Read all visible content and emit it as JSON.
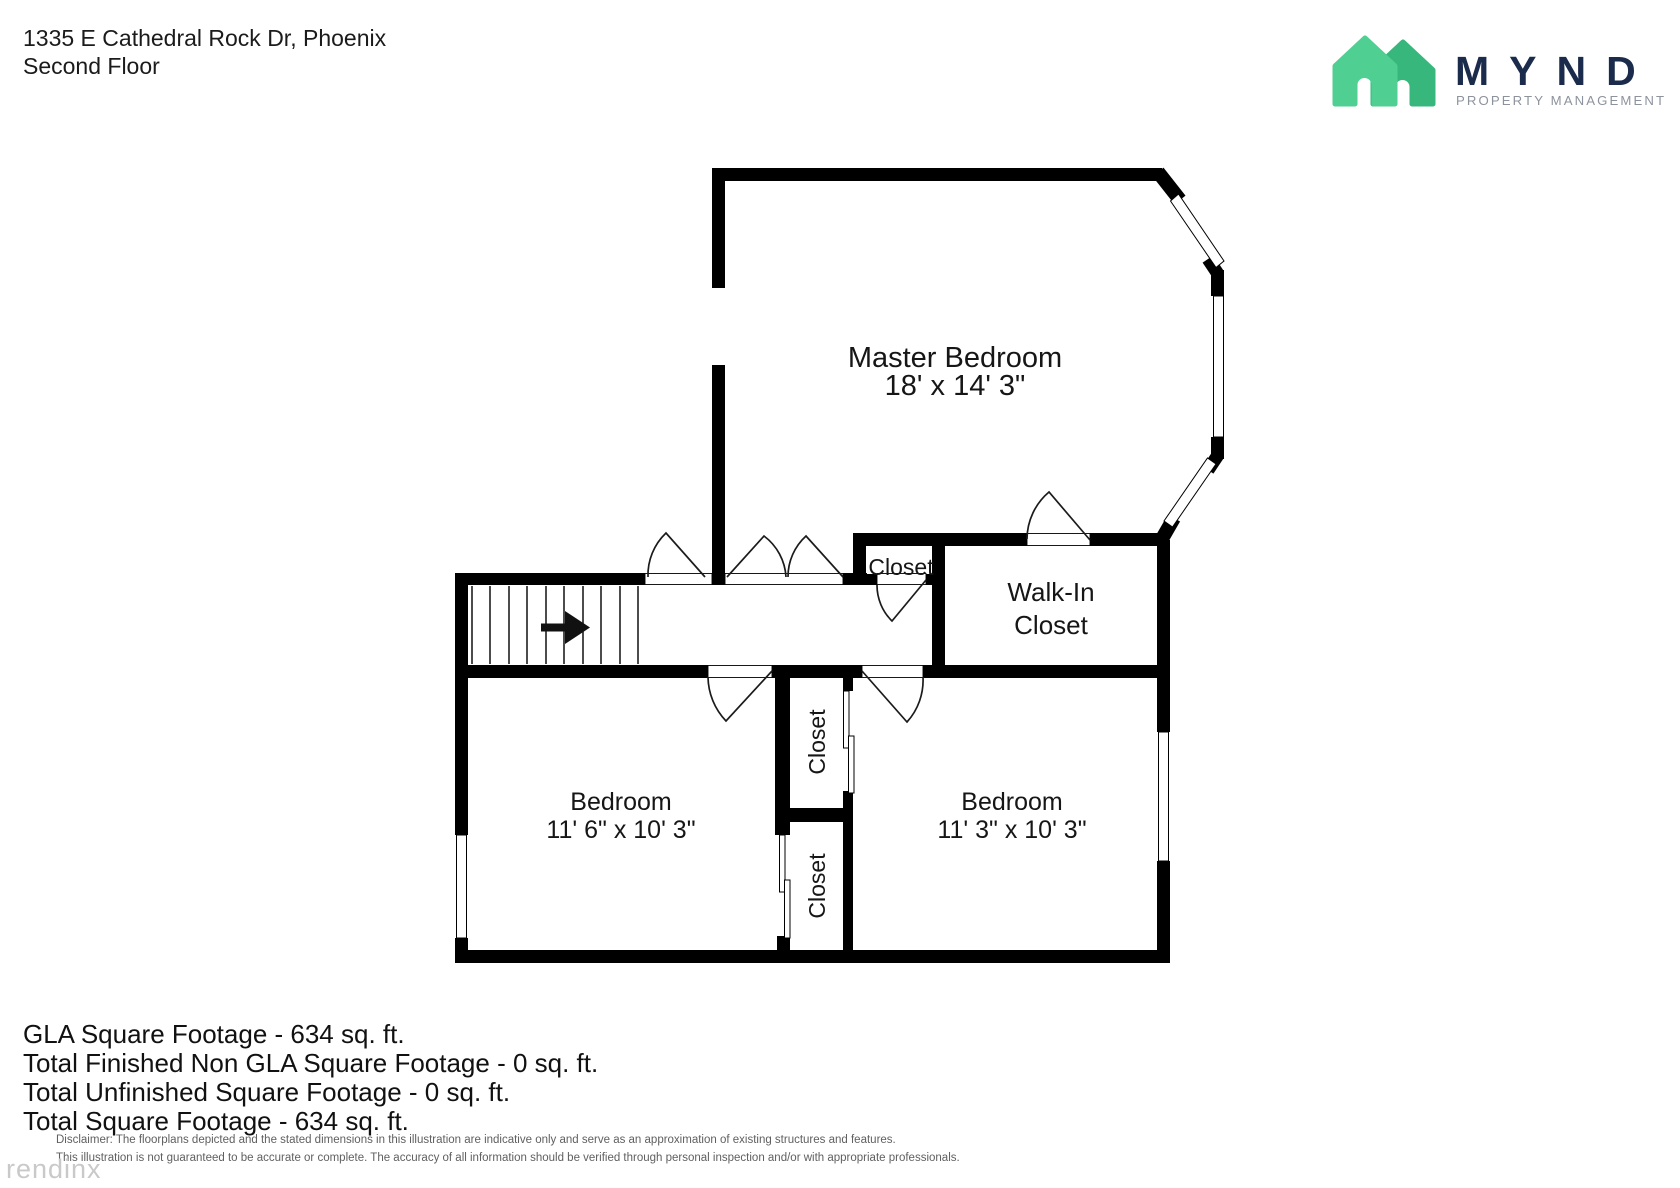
{
  "header": {
    "address": "1335 E Cathedral Rock Dr, Phoenix",
    "floor": "Second Floor"
  },
  "logo": {
    "brand": "MYND",
    "tagline": "PROPERTY MANAGEMENT",
    "colors": {
      "house_light": "#4fcf92",
      "house_dark": "#37b77c",
      "brand": "#1b2b4c",
      "tagline": "#8d939d"
    }
  },
  "plan": {
    "wall_color": "#000000",
    "master": {
      "name": "Master Bedroom",
      "dims": "18' x 14' 3\""
    },
    "walk_in_closet": {
      "line1": "Walk-In",
      "line2": "Closet"
    },
    "closet_hall": "Closet",
    "closet_upper": "Closet",
    "closet_lower": "Closet",
    "bedroom_left": {
      "name": "Bedroom",
      "dims": "11' 6\" x 10' 3\""
    },
    "bedroom_right": {
      "name": "Bedroom",
      "dims": "11' 3\" x 10' 3\""
    }
  },
  "summary": {
    "lines": [
      "GLA Square Footage - 634 sq. ft.",
      "Total Finished Non GLA Square Footage - 0 sq. ft.",
      "Total Unfinished Square Footage - 0 sq. ft.",
      "Total Square Footage - 634 sq. ft."
    ]
  },
  "disclaimer": {
    "line1": "Disclaimer: The floorplans depicted and the stated dimensions in this illustration are indicative only and serve as an approximation of existing structures and features.",
    "line2": "This illustration is not guaranteed to be accurate or complete. The accuracy of all information should be verified through personal inspection and/or with appropriate professionals."
  },
  "watermark": "rendinx"
}
